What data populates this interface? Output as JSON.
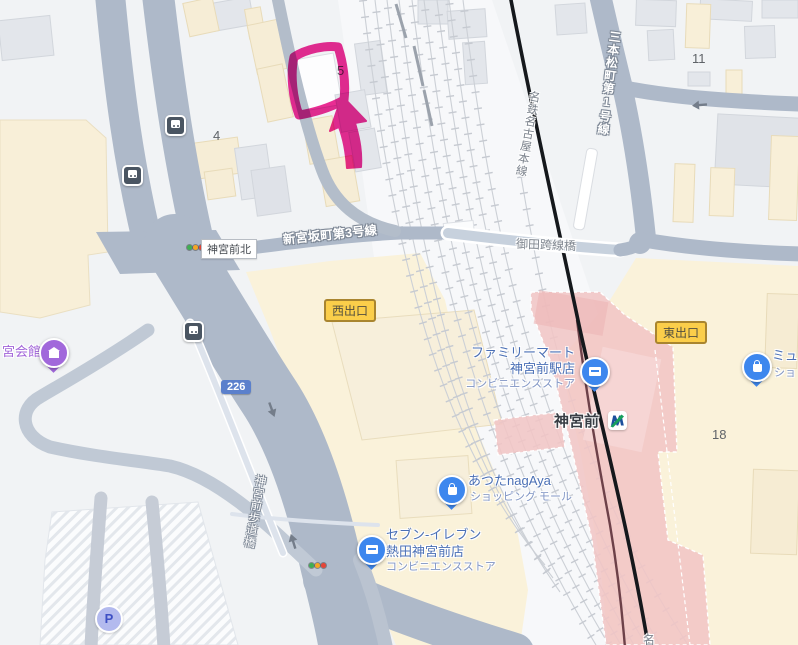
{
  "colors": {
    "annotation": "#ea1e8c",
    "road": "#aeb9c9",
    "station_pink": "#f1c5c5",
    "poi_blue_text": "#4a6fb5",
    "poi_purple_text": "#a163d9",
    "exit_badge_bg": "#fbce4a",
    "route_badge_bg": "#5b80cc",
    "cream_area": "#faf2da"
  },
  "roads": {
    "shinmiyasaka": "新宮坂町第3号線",
    "sanbonmatsu": "三本松町第1号線",
    "mita_bridge": "御田跨線橋",
    "meitetsu_line": "名鉄名古屋本線",
    "pedestrian_bridge": "神宮前歩道橋",
    "route_number": "226",
    "partial_rail_label": "名"
  },
  "intersections": {
    "jingumae_kita": "神宮前北"
  },
  "station": {
    "name": "神宮前"
  },
  "exits": {
    "west": "西出口",
    "east": "東出口"
  },
  "blocks": {
    "b4": "4",
    "b5": "5",
    "b11": "11",
    "b18": "18"
  },
  "pois": {
    "kaikan": {
      "name": "宮会館"
    },
    "familymart": {
      "line1": "ファミリーマート",
      "line2": "神宮前駅店",
      "category": "コンビニエンスストア"
    },
    "seveneleven": {
      "line1": "セブン-イレブン",
      "line2": "熱田神宮前店",
      "category": "コンビニエンスストア"
    },
    "atsuta": {
      "line1": "あつたnagAya",
      "category": "ショッピング モール"
    },
    "myu": {
      "line1": "ミュ",
      "category": "ショ"
    },
    "parking": {
      "label": "P"
    }
  }
}
